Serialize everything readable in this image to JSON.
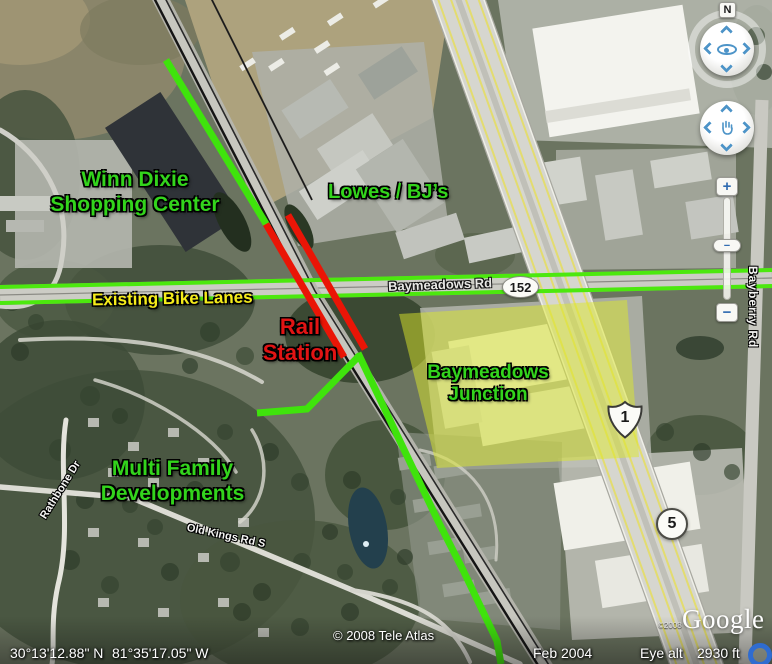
{
  "overlays": {
    "winn_dixie_line1": "Winn Dixie",
    "winn_dixie_line2": "Shopping Center",
    "lowes_bjs": "Lowes / BJ’s",
    "existing_bike_lanes": "Existing Bike Lanes",
    "rail_station_line1": "Rail",
    "rail_station_line2": "Station",
    "baymeadows_junction_line1": "Baymeadows",
    "baymeadows_junction_line2": "Junction",
    "multi_family_line1": "Multi Family",
    "multi_family_line2": "Developments",
    "colors": {
      "green_label": "#33d41c",
      "yellow_label": "#f5ec1a",
      "red_label": "#e11414",
      "route_green_line": "#3fe30c",
      "route_red_line": "#ea1506",
      "junction_highlight": "#dce829"
    }
  },
  "roads": {
    "baymeadows_rd": "Baymeadows Rd",
    "baymeadows_shield": "152",
    "us_route_shield": "1",
    "route_5_shield": "5",
    "bayberry_rd": "Bayberry Rd",
    "rathbone_dr": "Rathbone Dr",
    "old_kings_rd": "Old Kings Rd S"
  },
  "status": {
    "latitude": "30°13'12.88\" N",
    "longitude": "81°35'17.05\" W",
    "tele_atlas": "© 2008 Tele Atlas",
    "imagery_date": "Feb 2004",
    "eye_alt_label": "Eye alt",
    "eye_alt_value": "2930 ft",
    "google_logo": "Google",
    "google_small": "©2008"
  },
  "nav": {
    "north": "N",
    "zoom_in": "+",
    "zoom_out": "−",
    "zoom_handle": "−"
  }
}
